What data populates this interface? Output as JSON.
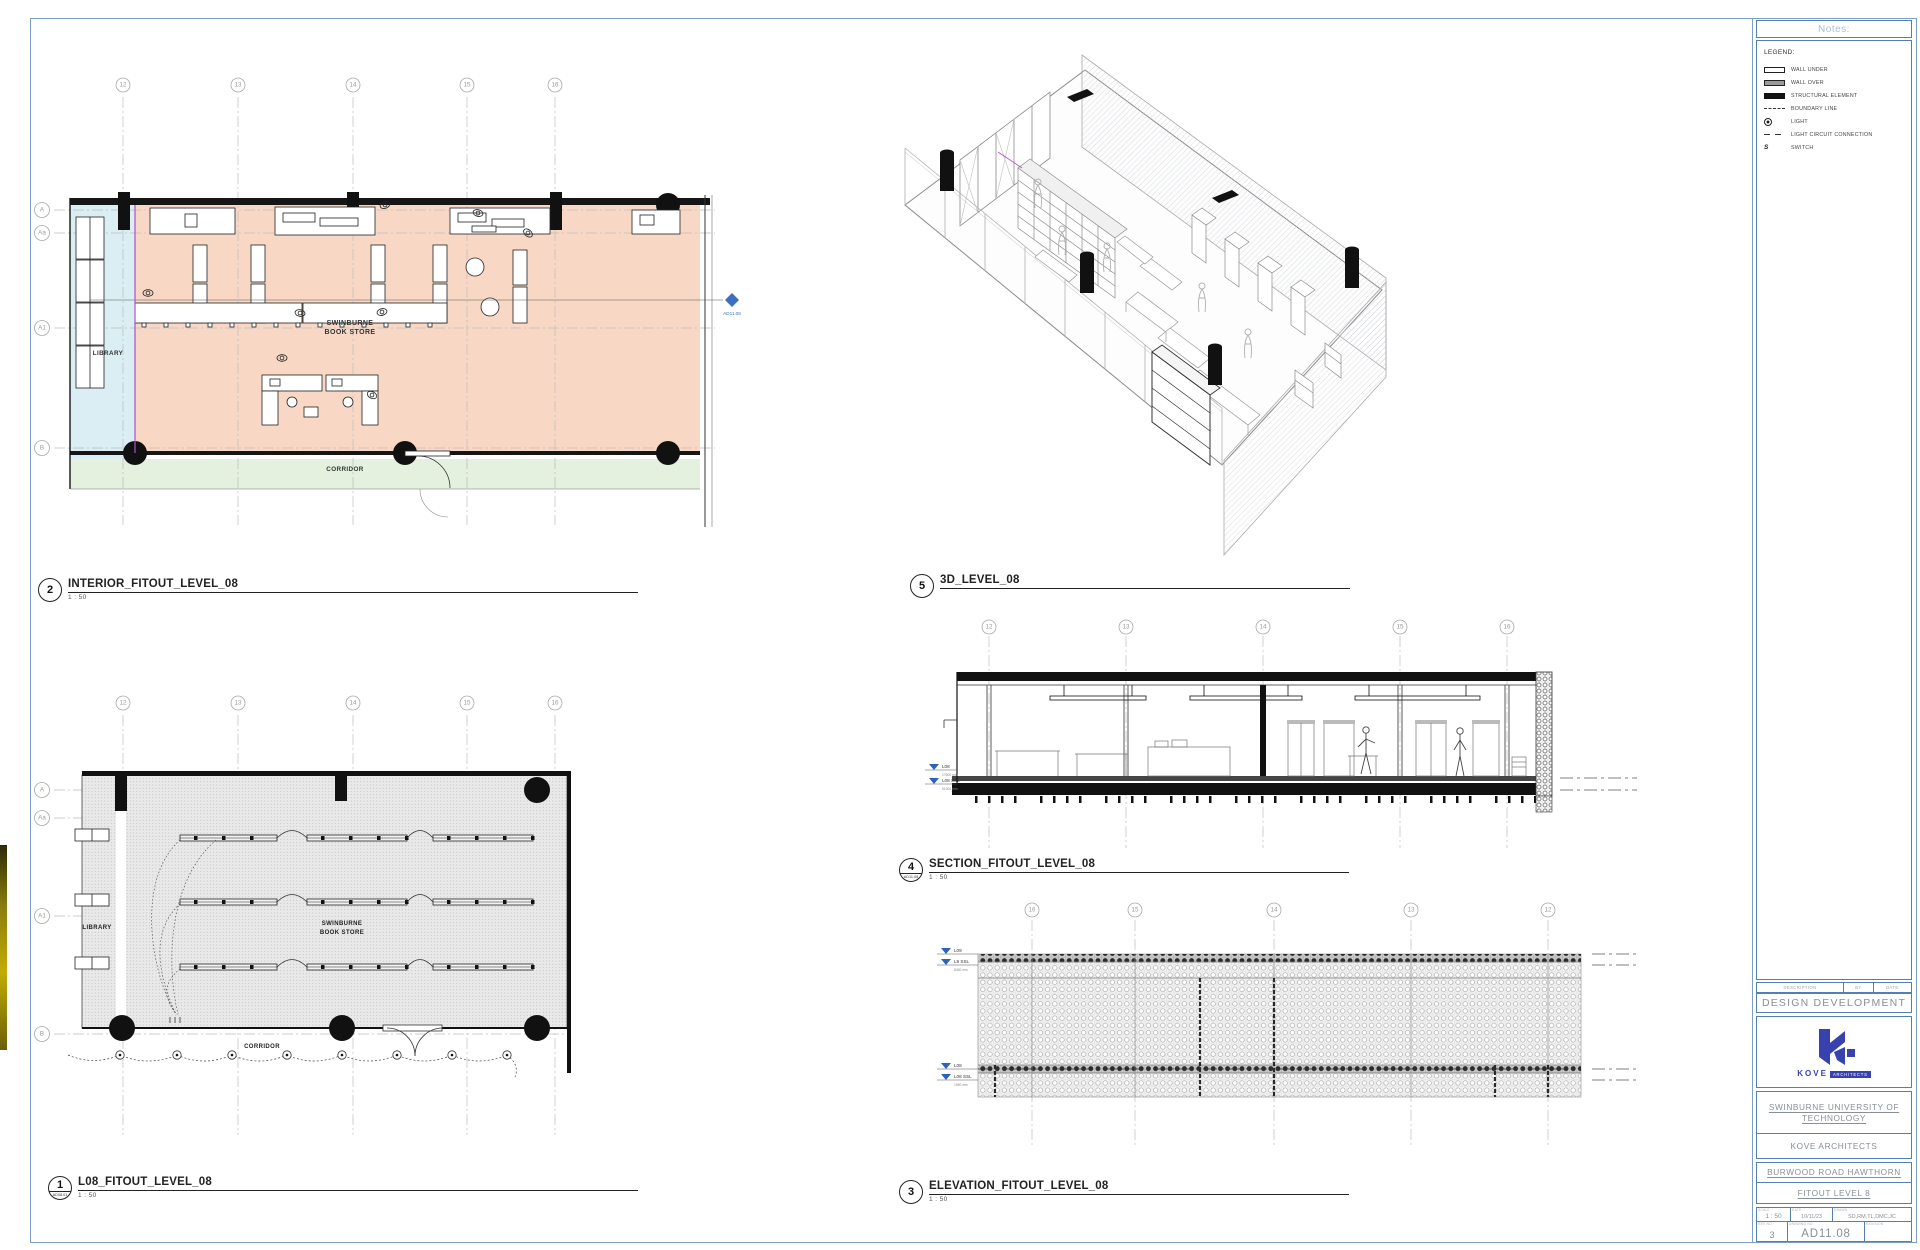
{
  "sheet": {
    "status": "DESIGN DEVELOPMENT",
    "number": "AD11.08",
    "name": "FITOUT LEVEL 8"
  },
  "views": {
    "interior": {
      "number": "2",
      "title": "INTERIOR_FITOUT_LEVEL_08",
      "scale": "1 : 50"
    },
    "three_d": {
      "number": "5",
      "title": "3D_LEVEL_08"
    },
    "section": {
      "number": "4",
      "ref": "AD11.08",
      "title": "SECTION_FITOUT_LEVEL_08",
      "scale": "1 : 50"
    },
    "elevation": {
      "number": "3",
      "title": "ELEVATION_FITOUT_LEVEL_08",
      "scale": "1 : 50"
    },
    "rcp": {
      "number": "1",
      "ref": "AD08.01",
      "title": "L08_FITOUT_LEVEL_08",
      "scale": "1 : 50"
    }
  },
  "plan_labels": {
    "store_line1": "SWINBURNE",
    "store_line2": "BOOK STORE",
    "library": "LIBRARY",
    "corridor": "CORRIDOR",
    "section_marker": "AD11.08"
  },
  "grids": {
    "plan_top": [
      "12",
      "13",
      "14",
      "15",
      "16"
    ],
    "plan_left": [
      "A",
      "Aa",
      "A1",
      "B"
    ],
    "elevation_top": [
      "16",
      "15",
      "14",
      "13",
      "12"
    ]
  },
  "levels": {
    "section": [
      {
        "name": "L08",
        "dim": "27500 mm"
      },
      {
        "name": "L08 SSL",
        "dim": "61300 mm"
      }
    ],
    "elevation": [
      {
        "name": "L09",
        "dim": ""
      },
      {
        "name": "L9 SSL",
        "dim": "8460 mm"
      },
      {
        "name": "L08",
        "dim": ""
      },
      {
        "name": "L08 SSL",
        "dim": "1550 mm"
      }
    ]
  },
  "title_block": {
    "notes_header": "Notes:",
    "legend": {
      "title": "LEGEND:",
      "items": [
        {
          "symbol": "wall-under",
          "label": "WALL UNDER"
        },
        {
          "symbol": "wall-over",
          "label": "WALL OVER"
        },
        {
          "symbol": "structural",
          "label": "STRUCTURAL ELEMENT"
        },
        {
          "symbol": "boundary",
          "label": "BOUNDARY LINE"
        },
        {
          "symbol": "light",
          "label": "LIGHT"
        },
        {
          "symbol": "circuit",
          "label": "LIGHT CIRCUIT CONNECTION"
        },
        {
          "symbol": "switch",
          "label": "SWITCH",
          "glyph": "S"
        }
      ]
    },
    "revision_table": {
      "columns": [
        "DESCRIPTION",
        "BY",
        "DATE"
      ]
    },
    "status": "DESIGN DEVELOPMENT",
    "logo": {
      "name": "KOVE",
      "sub": "ARCHITECTS"
    },
    "client": {
      "line1": "SWINBURNE UNIVERSITY OF",
      "line2": "TECHNOLOGY",
      "architect": "KOVE ARCHITECTS"
    },
    "project": {
      "address": "BURWOOD ROAD HAWTHORN",
      "name": "FITOUT LEVEL 8"
    },
    "info": {
      "scale_label": "SCALE",
      "scale": "1 : 50",
      "date_label": "DATE",
      "date": "10/11/23",
      "drawn_label": "DRAWN",
      "drawn": "SD,RM,TL,DMC,JC",
      "rev_label": "REV NO",
      "rev": "3",
      "number_label": "DRAWING NO.",
      "number": "AD11.08",
      "revision_label": "REVISION"
    }
  },
  "colors": {
    "frame_blue": "#7e9fc5",
    "box_blue": "#537fb4",
    "logo_blue": "#3742ae",
    "marker_blue": "#3f6ec0",
    "level_blue": "#2d62b8",
    "store_fill": "#f8d8c4",
    "library_fill": "#daeef3",
    "corridor_fill": "#e4f1de",
    "accent_purple": "#b04fc9"
  }
}
